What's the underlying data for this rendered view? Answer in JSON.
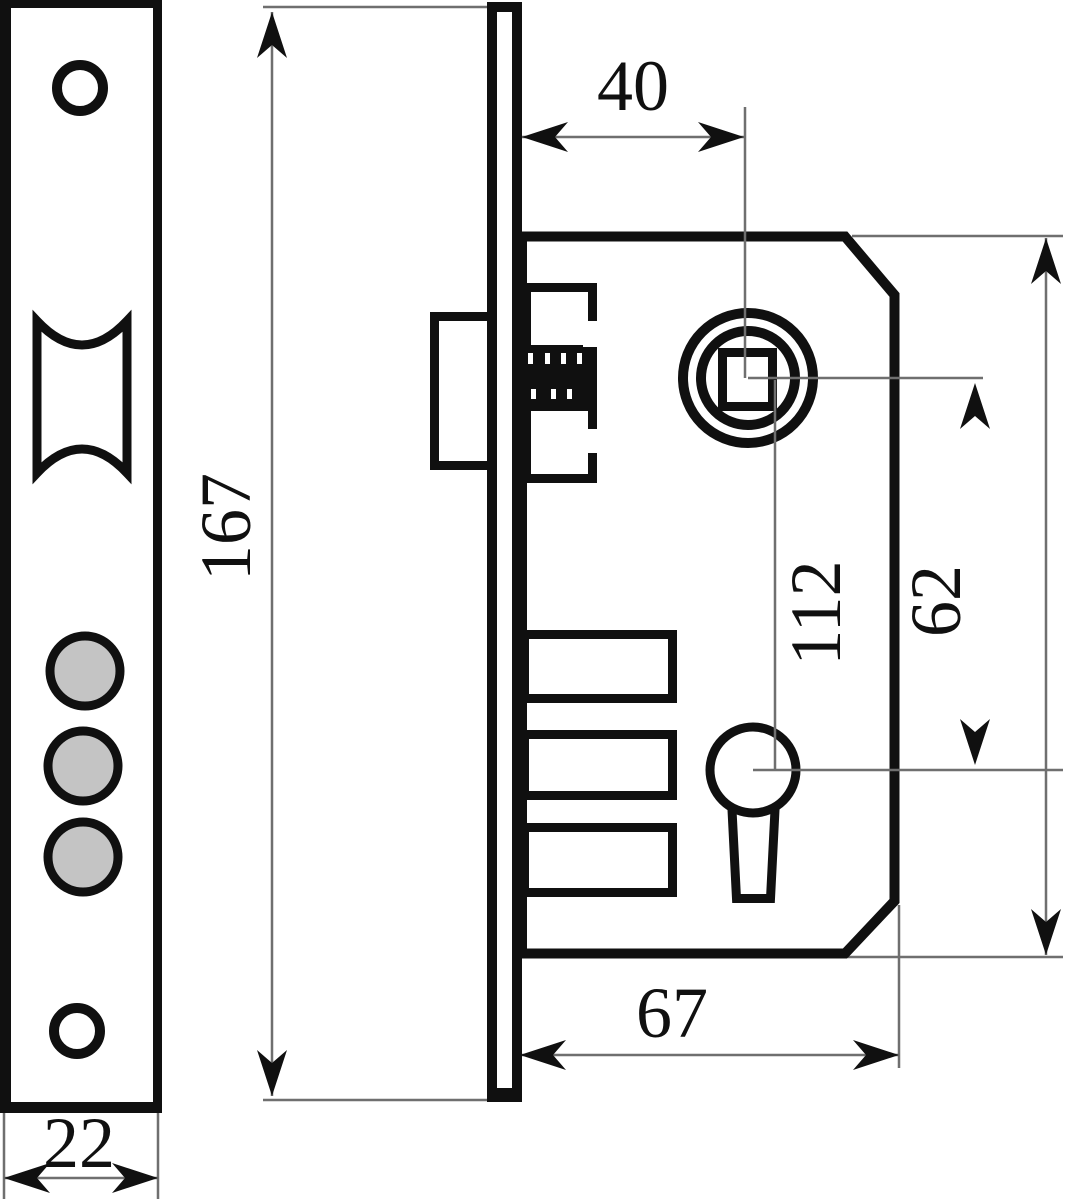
{
  "drawing": {
    "title": "Mortise lock technical drawing",
    "views": {
      "front": "faceplate front view",
      "side": "lock case side view"
    },
    "dimensions": {
      "faceplate_height": "167",
      "faceplate_width": "22",
      "backset": "40",
      "case_depth": "67",
      "spindle_to_keyhole": "62",
      "case_height": "112"
    },
    "colors": {
      "line": "#101010",
      "dim_line": "#6f6f6f",
      "roller_fill": "#c4c4c4",
      "background": "#ffffff"
    }
  }
}
